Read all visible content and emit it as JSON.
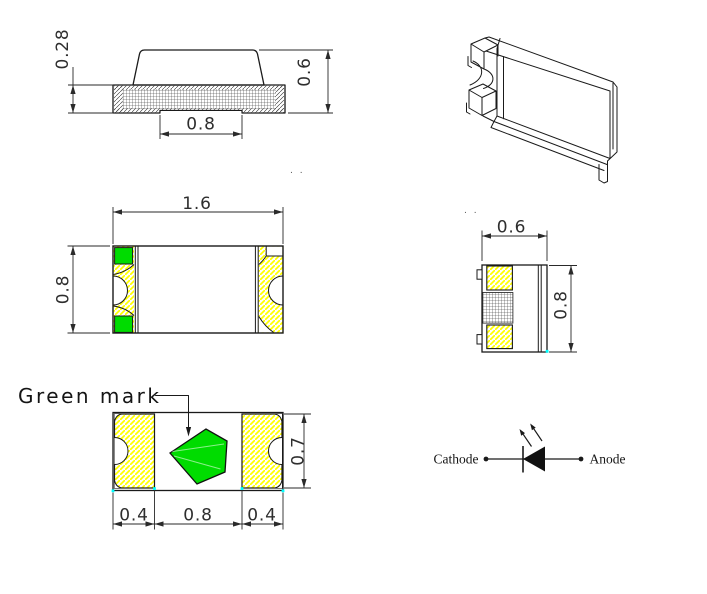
{
  "colors": {
    "line": "#1a1a1a",
    "dim_text": "#2e2e2e",
    "green_mark": "#00dc00",
    "hatch_yellow": "#ffff00",
    "snap_cyan": "#00ffff",
    "background": "#ffffff"
  },
  "side_view": {
    "dim_base_height": "0.28",
    "dim_total_height": "0.6",
    "dim_bottom_notch_width": "0.8",
    "stray_marks": ". ."
  },
  "top_view": {
    "dim_length": "1.6",
    "dim_width": "0.8"
  },
  "bottom_view": {
    "callout_label": "Green mark",
    "dim_left_pad": "0.4",
    "dim_center_gap": "0.8",
    "dim_right_pad": "0.4",
    "dim_pad_height": "0.7"
  },
  "iso_view": {
    "stray_marks": ". ."
  },
  "end_view": {
    "dim_width": "0.6",
    "dim_height": "0.8"
  },
  "led_symbol": {
    "cathode_label": "Cathode",
    "anode_label": "Anode"
  }
}
